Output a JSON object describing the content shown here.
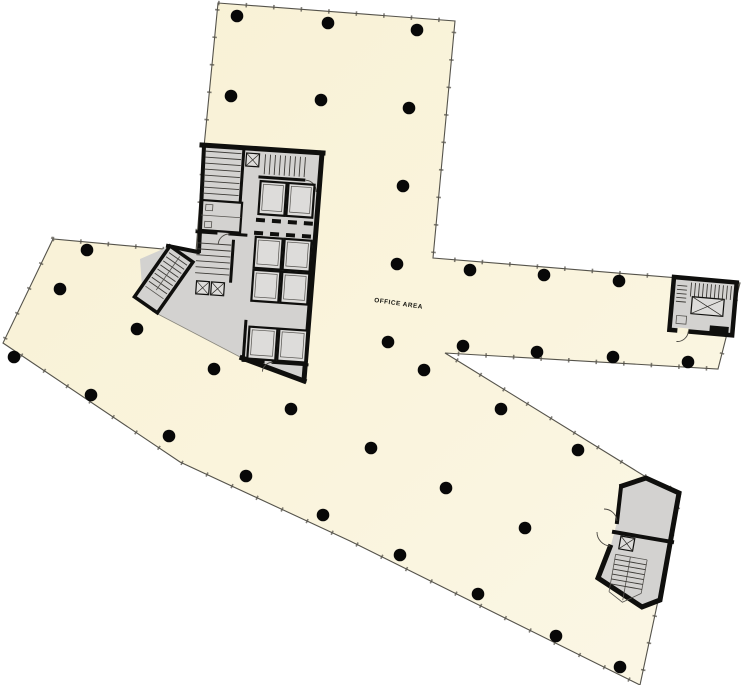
{
  "plan": {
    "office_area_label": "OFFICE AREA",
    "label_position": {
      "x": 374,
      "y": 302,
      "rotation": 8
    },
    "colors": {
      "background": "#ffffff",
      "floor_fill": "#f9f3da",
      "floor_fill_light": "#fcf8ea",
      "floor_stroke": "#55534b",
      "core_fill": "#d3d2d0",
      "elevator_fill": "#dddcda",
      "wall": "#0f0f0d",
      "column": "#080808"
    },
    "floor_outline": [
      [
        218,
        3
      ],
      [
        455,
        21
      ],
      [
        433,
        258
      ],
      [
        740,
        283
      ],
      [
        718,
        369
      ],
      [
        445,
        353
      ],
      [
        646,
        477
      ],
      [
        681,
        493
      ],
      [
        640,
        685
      ],
      [
        350,
        541
      ],
      [
        180,
        462
      ],
      [
        3,
        343
      ],
      [
        53,
        239
      ],
      [
        196,
        252
      ],
      [
        204,
        147
      ]
    ],
    "columns": {
      "radius": 6.3,
      "points": [
        [
          237,
          16
        ],
        [
          328,
          23
        ],
        [
          417,
          30
        ],
        [
          231,
          96
        ],
        [
          321,
          100
        ],
        [
          409,
          108
        ],
        [
          403,
          186
        ],
        [
          397,
          264
        ],
        [
          470,
          270
        ],
        [
          544,
          275
        ],
        [
          619,
          281
        ],
        [
          463,
          346
        ],
        [
          537,
          352
        ],
        [
          613,
          357
        ],
        [
          688,
          362
        ],
        [
          388,
          342
        ],
        [
          424,
          370
        ],
        [
          291,
          409
        ],
        [
          501,
          409
        ],
        [
          578,
          450
        ],
        [
          371,
          448
        ],
        [
          446,
          488
        ],
        [
          525,
          528
        ],
        [
          400,
          555
        ],
        [
          478,
          594
        ],
        [
          556,
          636
        ],
        [
          620,
          667
        ],
        [
          323,
          515
        ],
        [
          246,
          476
        ],
        [
          169,
          436
        ],
        [
          91,
          395
        ],
        [
          14,
          357
        ],
        [
          60,
          289
        ],
        [
          87,
          250
        ],
        [
          137,
          329
        ],
        [
          214,
          369
        ]
      ]
    },
    "structures": [
      "central-service-core",
      "west-stair-block",
      "east-stair-room",
      "southeast-stair-core"
    ]
  }
}
